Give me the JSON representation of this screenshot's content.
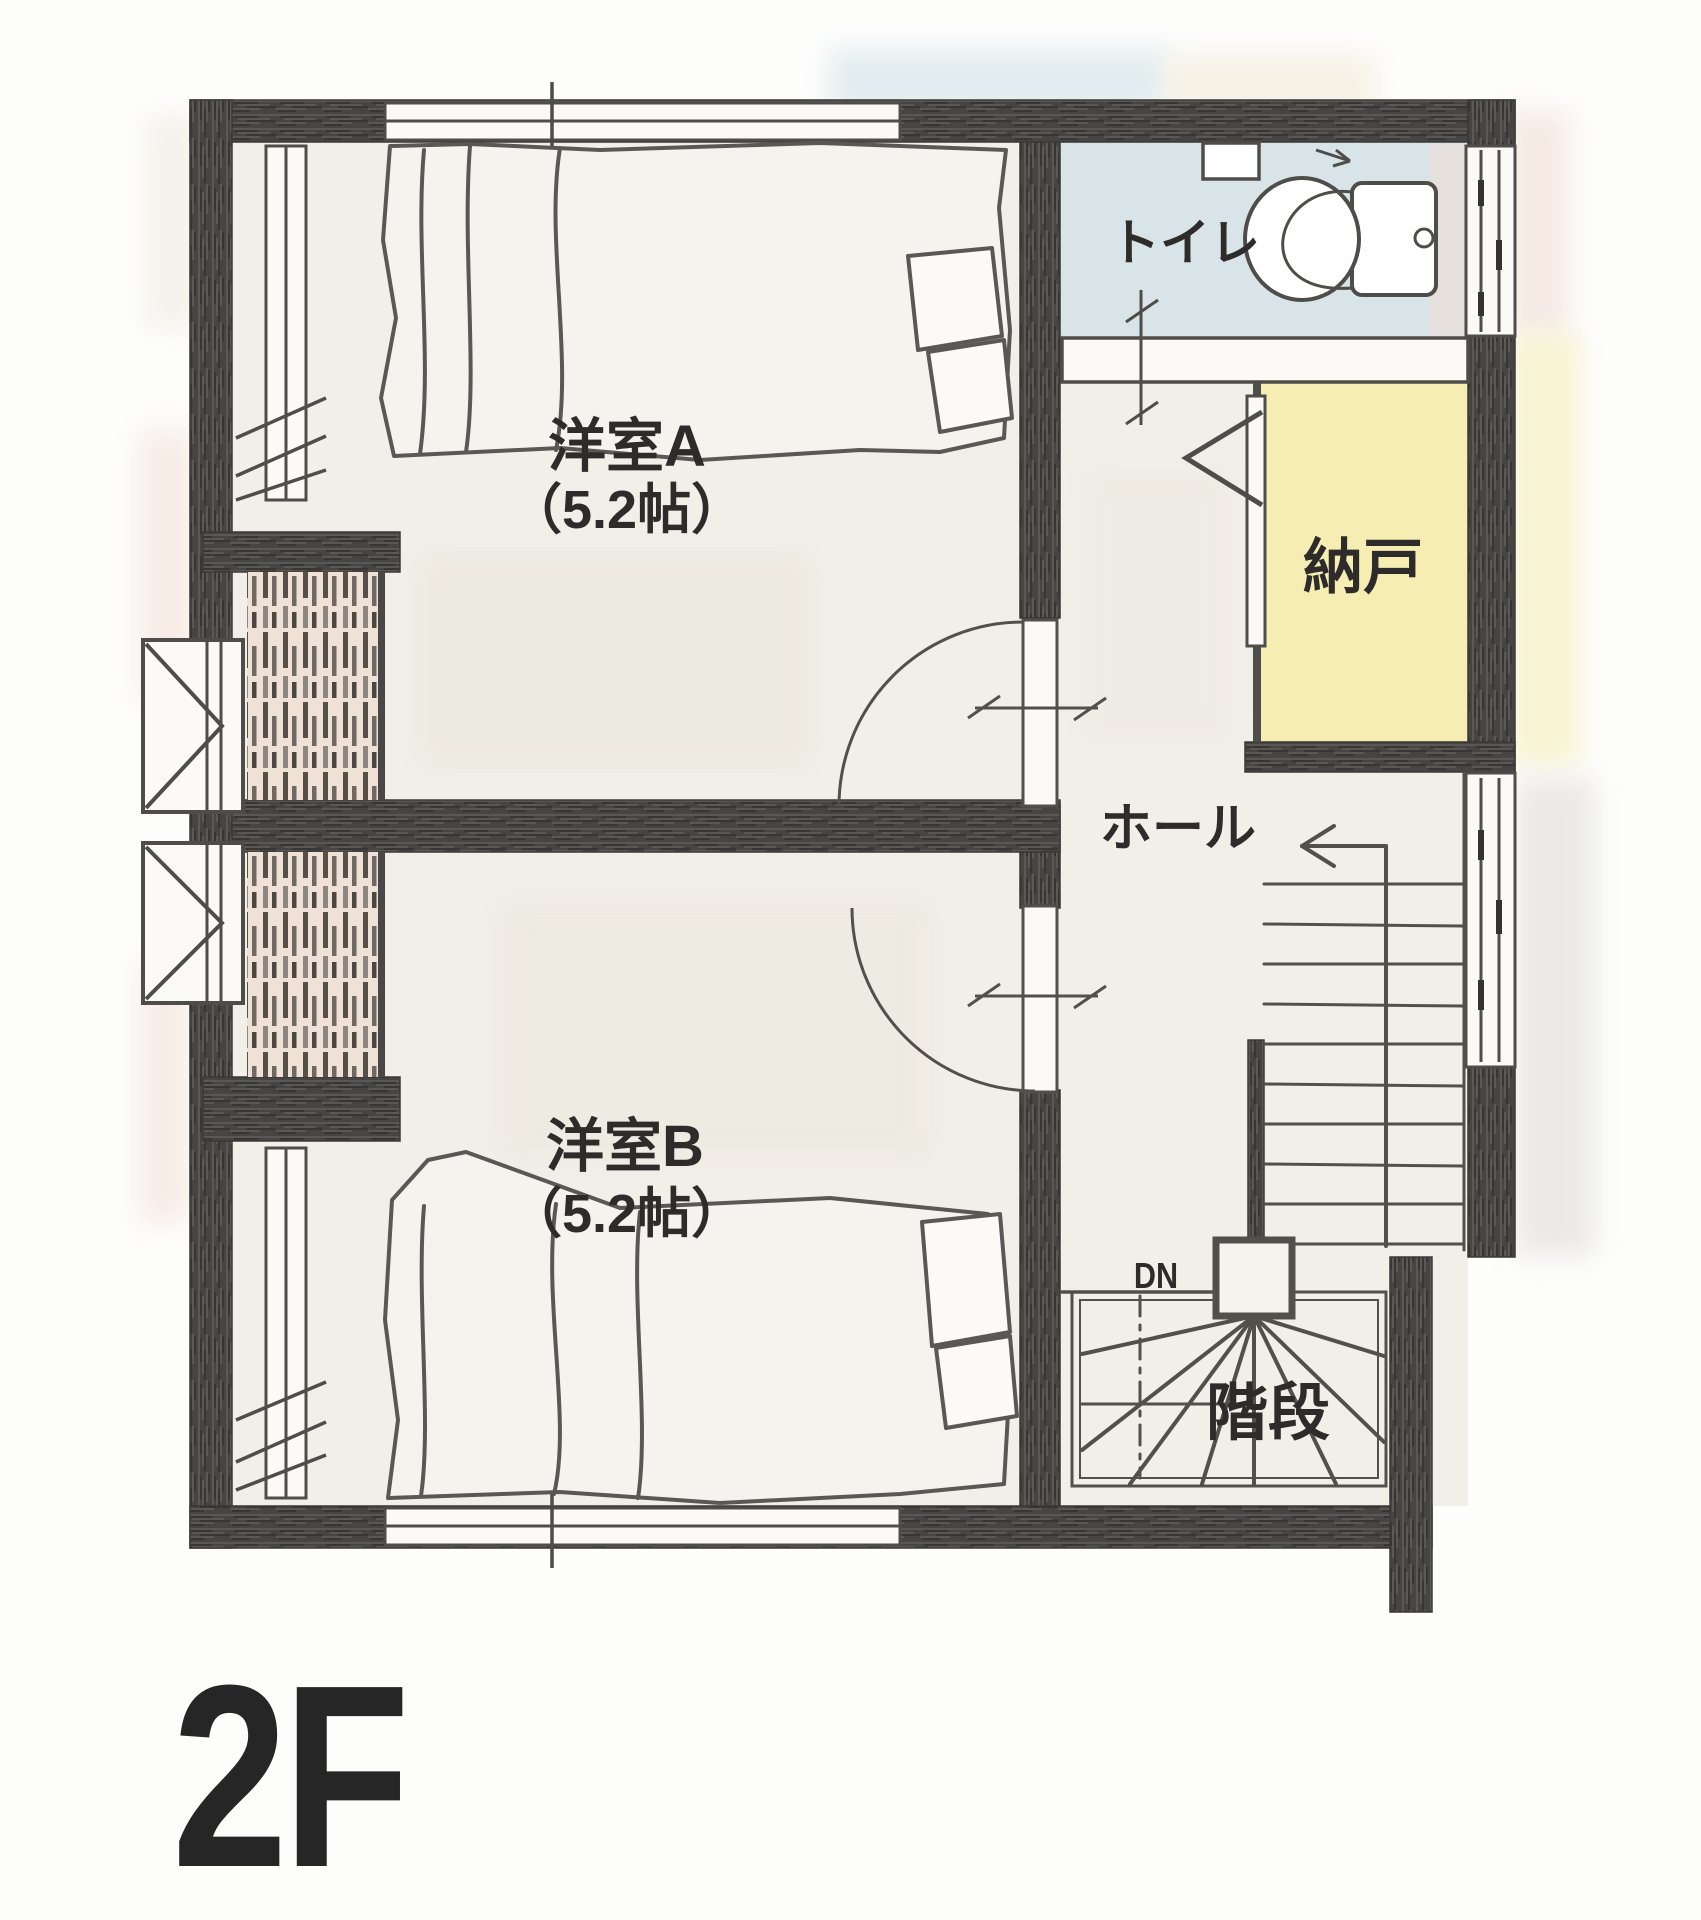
{
  "floor_plan": {
    "title": "2F",
    "rooms": {
      "western_a": {
        "label": "洋室A",
        "size": "（5.2帖）"
      },
      "western_b": {
        "label": "洋室B",
        "size": "（5.2帖）"
      },
      "toilet": {
        "label": "トイレ"
      },
      "storage": {
        "label": "納戸"
      },
      "hall": {
        "label": "ホール"
      },
      "stairs": {
        "label": "階段",
        "direction_label": "DN"
      }
    },
    "colors": {
      "wall": "#474543",
      "line": "#53504c",
      "floor": "#f1efe8",
      "toilet_floor": "#d8e4e7",
      "storage_floor": "#f5edb2",
      "closet_tint": "#f0e1d6",
      "text": "#2d2c2a",
      "title_text": "#262626"
    }
  }
}
